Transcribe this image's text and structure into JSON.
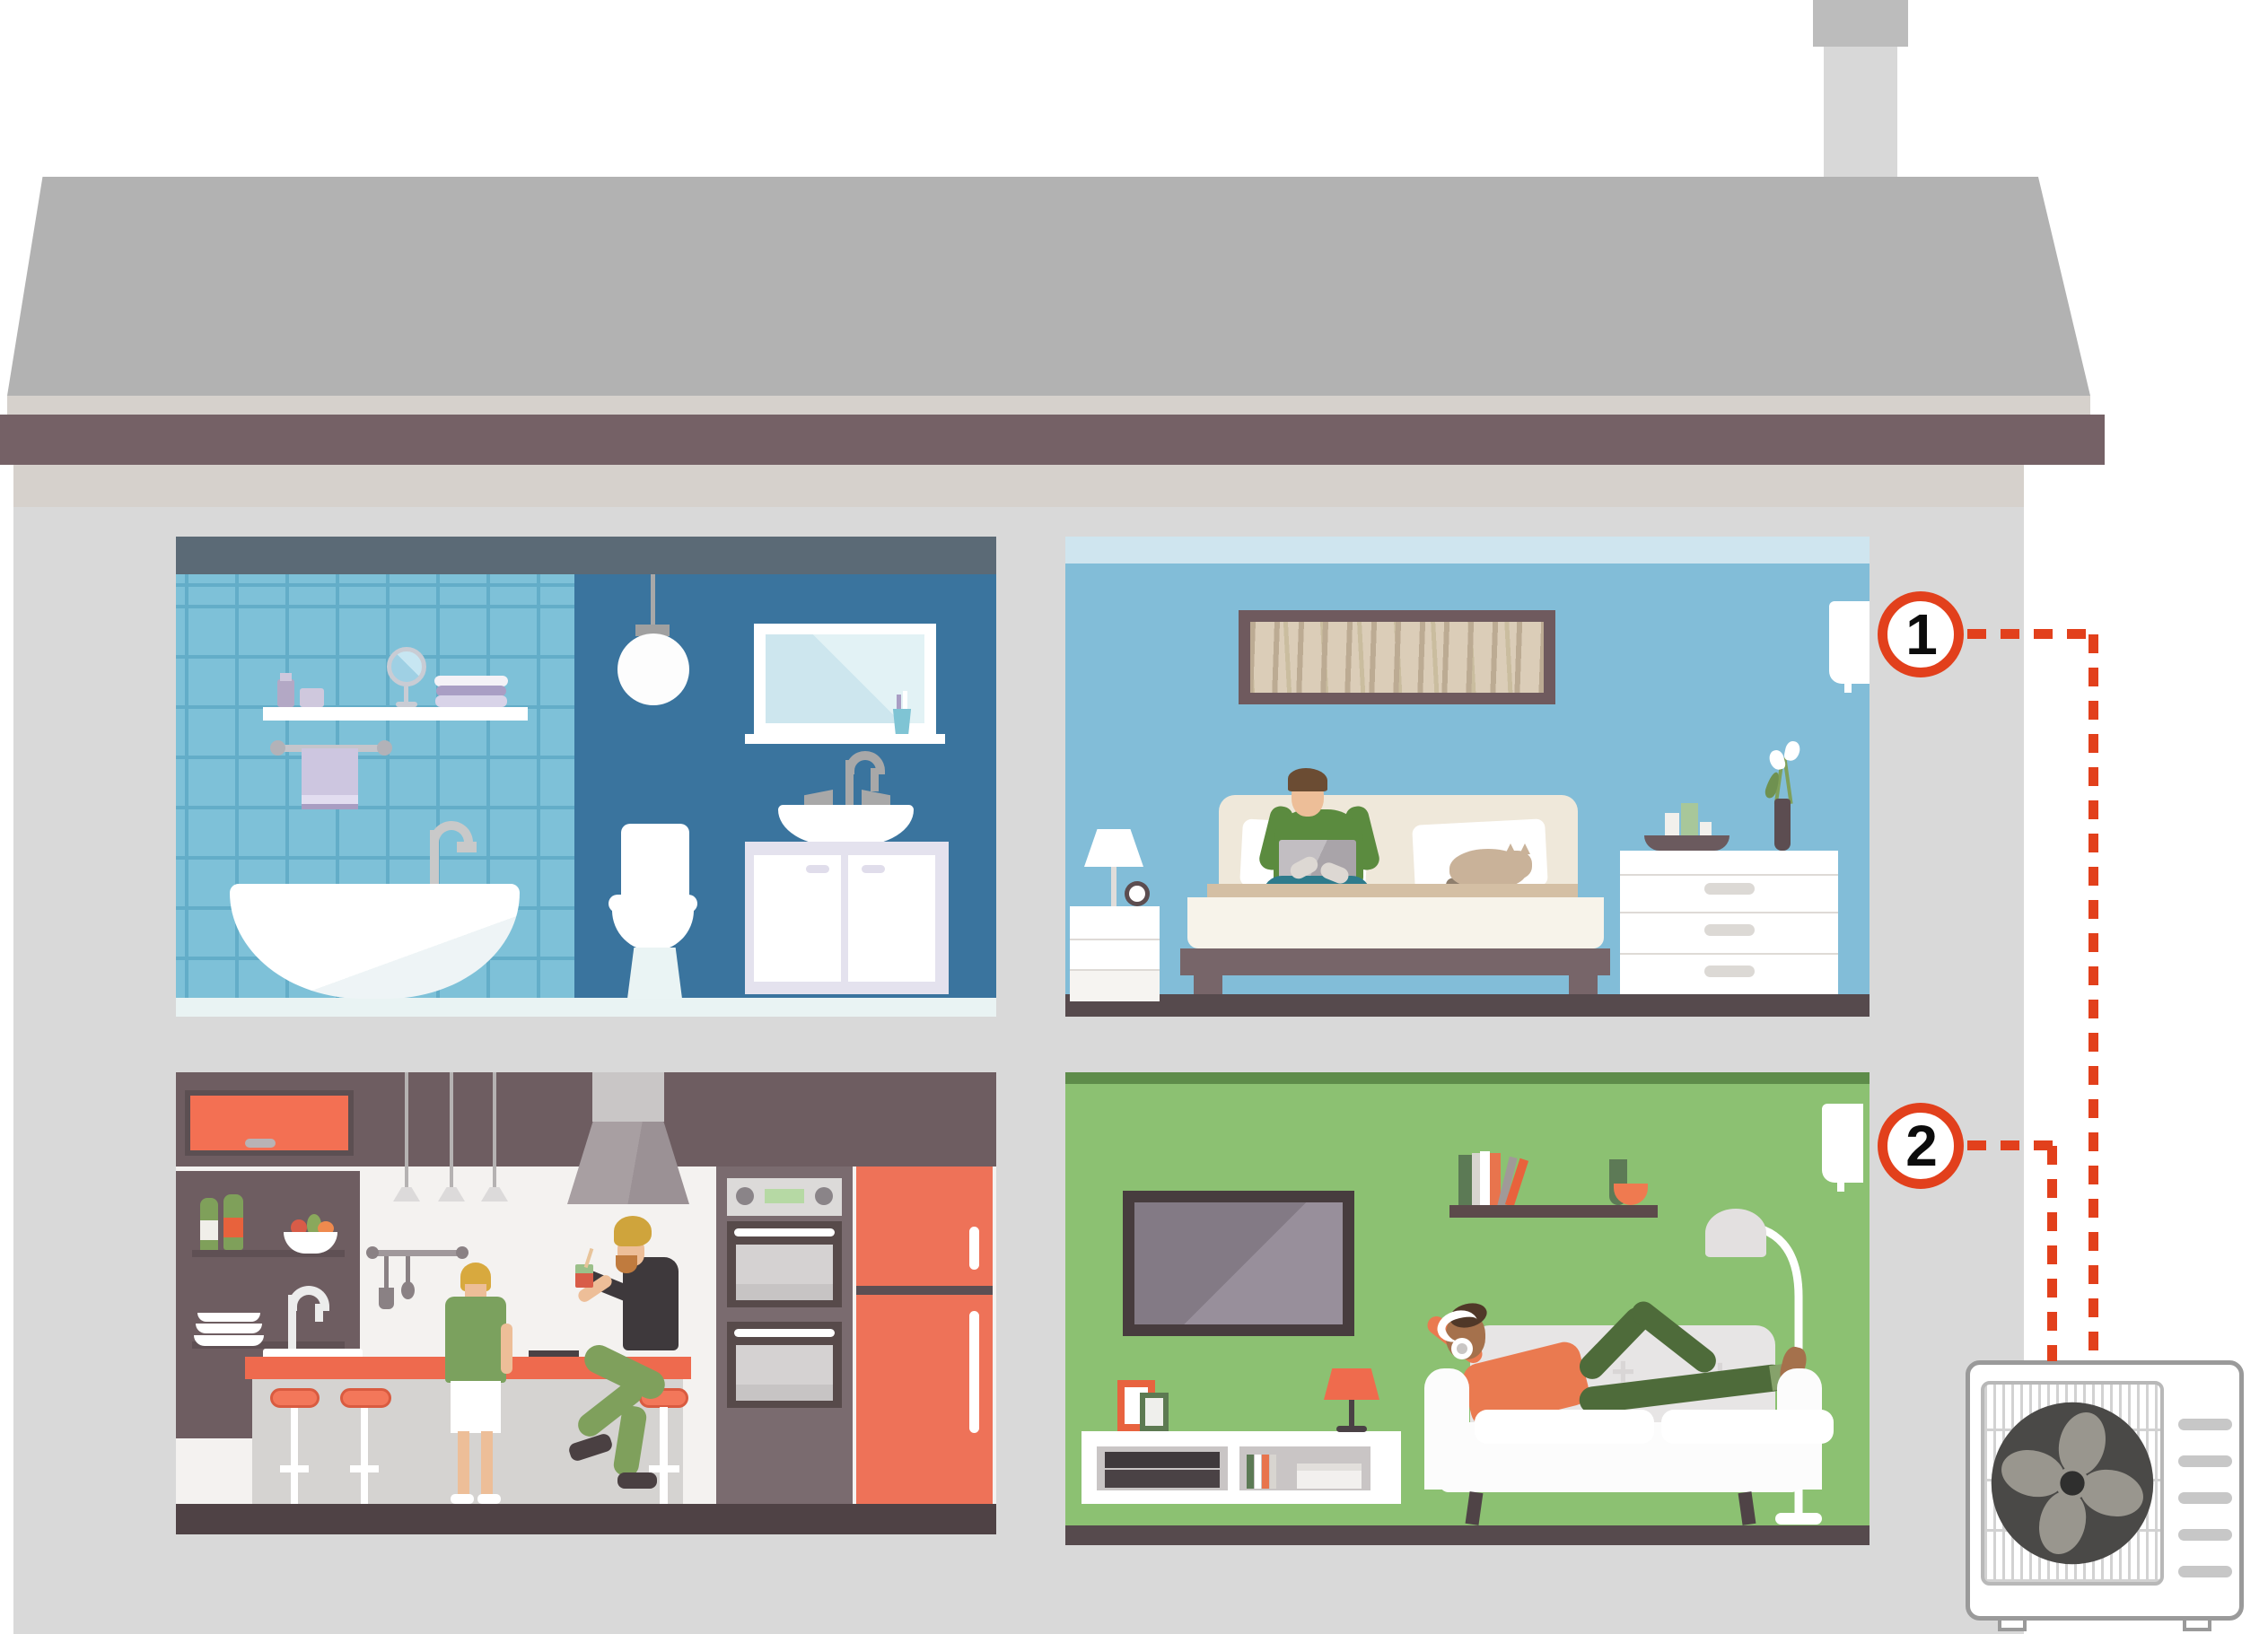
{
  "markers": [
    {
      "label": "1"
    },
    {
      "label": "2"
    }
  ],
  "colors": {
    "accent": "#e2401c",
    "roof": "#b2b2b2",
    "chimney": "#d8d8d8",
    "chimney_cap": "#bcbcbc",
    "fascia": "#756166",
    "house_wall": "#d9d9d9",
    "eaves_strip": "#d6d1cc",
    "bathroom_tile": "#7ec1d8",
    "bathroom_tile_grout": "#63adc8",
    "bathroom_wall_dark": "#3a749e",
    "bathroom_ceiling": "#5b6a76",
    "bathroom_floor": "#e9f3f3",
    "bedroom_wall": "#82bdd8",
    "bedroom_ceiling": "#cfe5ef",
    "kitchen_wall": "#f4f2f0",
    "kitchen_dark": "#6e5d61",
    "living_wall": "#8cc172",
    "living_ceiling": "#5e8c4a",
    "floor_dark": "#564a4d",
    "kitchen_floor_dark": "#4f4245",
    "accent_orange": "#ee6a4e",
    "unit_outline": "#9a9a9a"
  }
}
